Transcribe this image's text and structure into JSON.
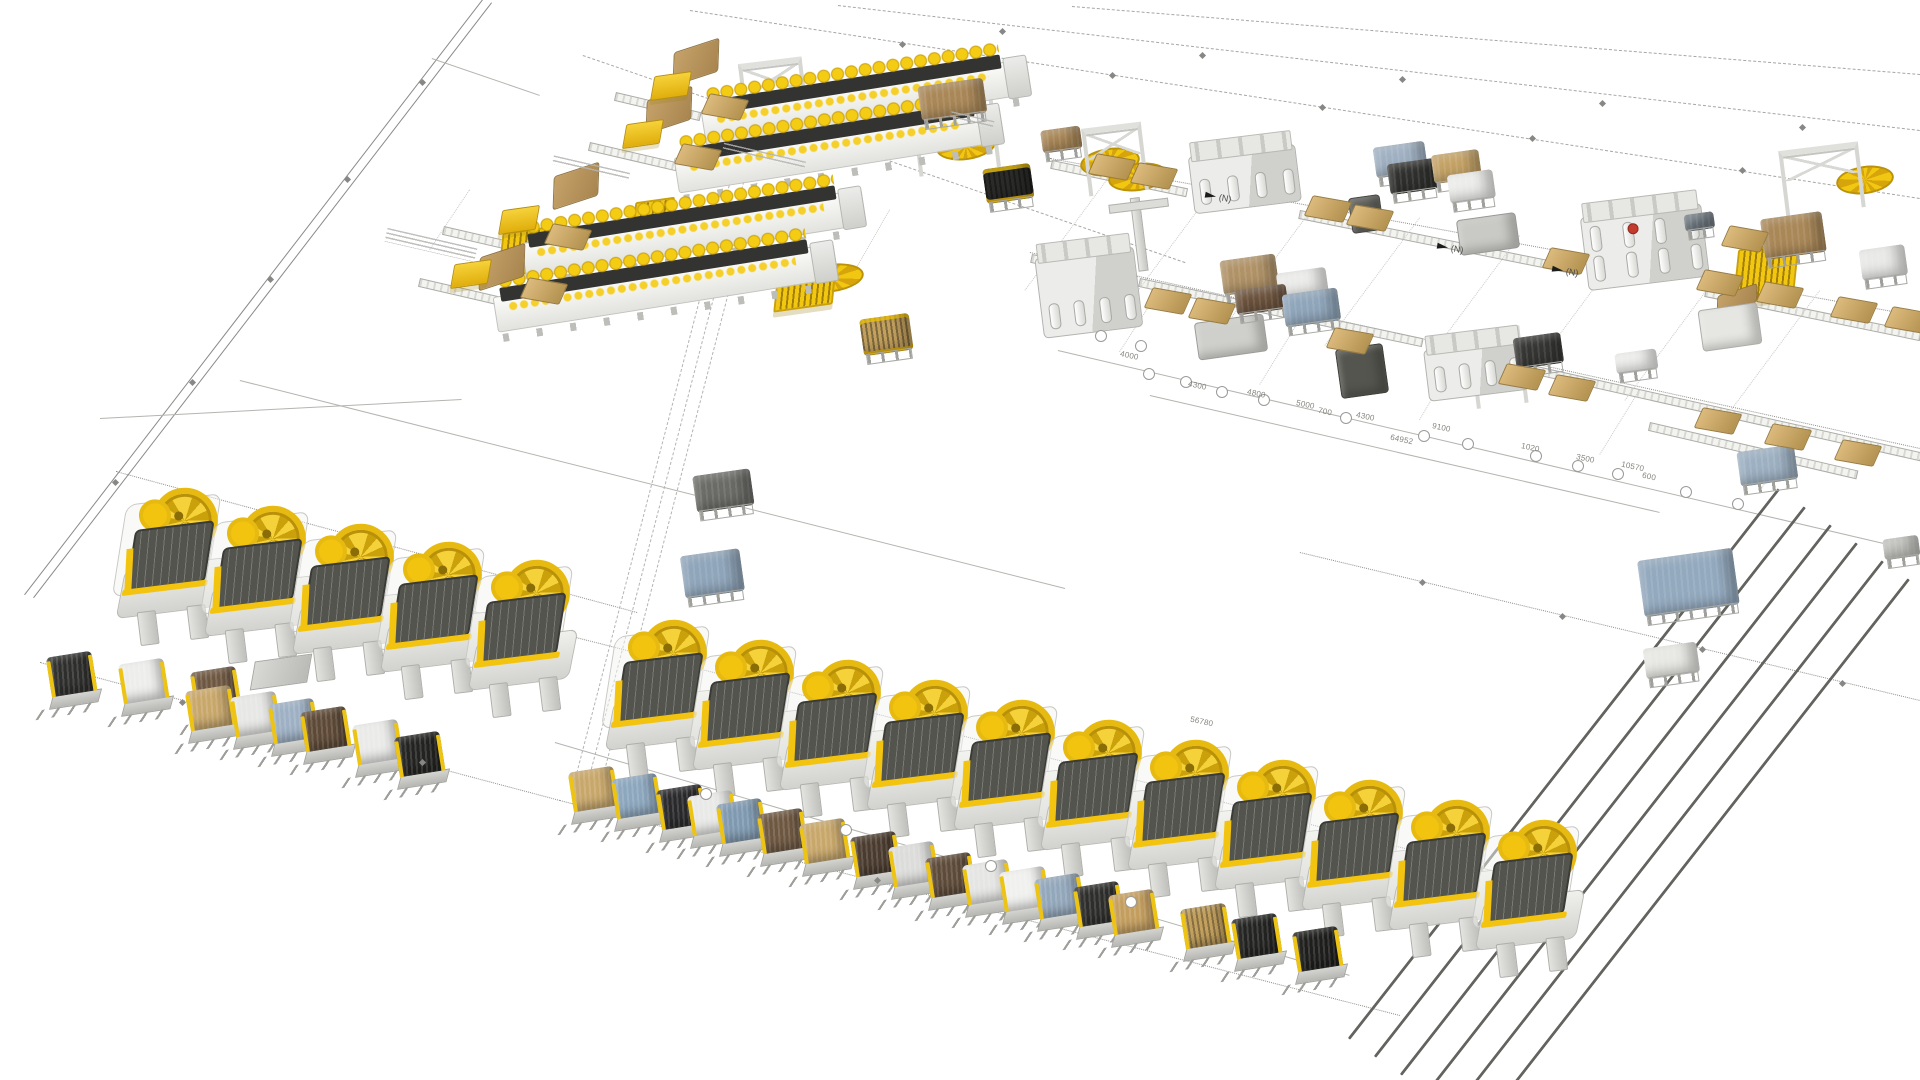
{
  "document": {
    "kind": "isometric 3D plant layout drawing",
    "background_color": "#ffffff"
  },
  "palette": {
    "accent_yellow": "#f2c40f",
    "machine_light": "#e9e9e5",
    "machine_dark": "#54544e",
    "bale_tan": "#c8a76a",
    "line_gray": "#9c9c9a",
    "logo_red": "#c23b2e"
  },
  "flow_markers": [
    {
      "label": "(N)",
      "x": 1205,
      "y": 192
    },
    {
      "label": "(N)",
      "x": 1437,
      "y": 243
    },
    {
      "label": "(N)",
      "x": 1552,
      "y": 266
    }
  ],
  "dimension_labels": [
    {
      "text": "4000",
      "x": 1120,
      "y": 352
    },
    {
      "text": "4300",
      "x": 1188,
      "y": 382
    },
    {
      "text": "4800",
      "x": 1247,
      "y": 390
    },
    {
      "text": "5000",
      "x": 1296,
      "y": 401
    },
    {
      "text": "700",
      "x": 1318,
      "y": 408
    },
    {
      "text": "4300",
      "x": 1356,
      "y": 413
    },
    {
      "text": "64952",
      "x": 1390,
      "y": 436
    },
    {
      "text": "9100",
      "x": 1432,
      "y": 424
    },
    {
      "text": "1020",
      "x": 1521,
      "y": 444
    },
    {
      "text": "3500",
      "x": 1576,
      "y": 455
    },
    {
      "text": "10570",
      "x": 1621,
      "y": 463
    },
    {
      "text": "600",
      "x": 1642,
      "y": 473
    },
    {
      "text": "56780",
      "x": 1190,
      "y": 718
    }
  ],
  "scene": {
    "lines": [
      [
        483,
        0,
        25,
        595,
        "solid"
      ],
      [
        492,
        3,
        34,
        598,
        "solid"
      ],
      [
        690,
        10,
        1920,
        198,
        "dashed"
      ],
      [
        838,
        5,
        1920,
        130,
        "dashed"
      ],
      [
        1072,
        6,
        1920,
        74,
        "dashed"
      ],
      [
        583,
        55,
        1185,
        262,
        "dashed"
      ],
      [
        432,
        58,
        540,
        95,
        "dim"
      ],
      [
        100,
        418,
        462,
        399,
        "dim"
      ],
      [
        116,
        471,
        637,
        612,
        "dotted"
      ],
      [
        240,
        380,
        1065,
        588,
        "dim"
      ],
      [
        1050,
        158,
        1920,
        316,
        "dotted"
      ],
      [
        1030,
        252,
        1920,
        448,
        "dotted"
      ],
      [
        1058,
        350,
        1905,
        548,
        "dim"
      ],
      [
        1150,
        395,
        1660,
        512,
        "dim"
      ],
      [
        1300,
        552,
        1920,
        700,
        "dotted"
      ],
      [
        40,
        662,
        560,
        800,
        "dotted"
      ],
      [
        560,
        800,
        1400,
        1015,
        "dotted"
      ],
      [
        470,
        610,
        1570,
        890,
        "dotted"
      ],
      [
        555,
        742,
        1350,
        975,
        "dim"
      ],
      [
        753,
        148,
        588,
        784,
        "spine"
      ],
      [
        765,
        154,
        600,
        790,
        "spine"
      ],
      [
        741,
        142,
        576,
        778,
        "spine"
      ],
      [
        1780,
        490,
        1350,
        1040,
        "rail"
      ],
      [
        1806,
        508,
        1376,
        1058,
        "rail"
      ],
      [
        1832,
        526,
        1402,
        1076,
        "rail"
      ],
      [
        1858,
        544,
        1428,
        1094,
        "rail"
      ],
      [
        1884,
        562,
        1454,
        1112,
        "rail"
      ],
      [
        1910,
        580,
        1480,
        1130,
        "rail"
      ],
      [
        1052,
        160,
        1186,
        188,
        "conv"
      ],
      [
        1300,
        210,
        1578,
        266,
        "conv"
      ],
      [
        1706,
        288,
        1920,
        332,
        "conv"
      ],
      [
        1032,
        254,
        1136,
        276,
        "conv"
      ],
      [
        1140,
        278,
        1422,
        338,
        "conv"
      ],
      [
        1528,
        364,
        1920,
        452,
        "conv"
      ],
      [
        1650,
        422,
        1856,
        470,
        "conv"
      ],
      [
        616,
        92,
        700,
        112,
        "conv"
      ],
      [
        590,
        142,
        676,
        162,
        "conv"
      ],
      [
        444,
        226,
        522,
        244,
        "conv"
      ],
      [
        420,
        278,
        498,
        296,
        "conv"
      ],
      [
        1120,
        163,
        1025,
        291,
        "faint"
      ],
      [
        1220,
        181,
        1125,
        309,
        "faint"
      ],
      [
        1320,
        199,
        1225,
        327,
        "faint"
      ],
      [
        1420,
        218,
        1325,
        346,
        "faint"
      ],
      [
        1520,
        236,
        1425,
        364,
        "faint"
      ],
      [
        1620,
        254,
        1525,
        382,
        "faint"
      ],
      [
        1720,
        273,
        1625,
        401,
        "faint"
      ],
      [
        1820,
        291,
        1725,
        419,
        "faint"
      ],
      [
        1160,
        290,
        1120,
        352,
        "faint"
      ],
      [
        1300,
        320,
        1260,
        385,
        "faint"
      ],
      [
        1460,
        352,
        1420,
        420,
        "faint"
      ],
      [
        1640,
        390,
        1600,
        455,
        "faint"
      ],
      [
        1800,
        425,
        1760,
        492,
        "faint"
      ],
      [
        470,
        190,
        430,
        250,
        "faint"
      ],
      [
        890,
        210,
        850,
        280,
        "faint"
      ]
    ],
    "fiber_opening_machines": [
      [
        118,
        498
      ],
      [
        206,
        516
      ],
      [
        294,
        534
      ],
      [
        382,
        552
      ],
      [
        470,
        570
      ],
      [
        607,
        630
      ],
      [
        694,
        650
      ],
      [
        781,
        670
      ],
      [
        868,
        690
      ],
      [
        955,
        710
      ],
      [
        1042,
        730
      ],
      [
        1129,
        750
      ],
      [
        1216,
        770
      ],
      [
        1303,
        790
      ],
      [
        1390,
        810
      ],
      [
        1477,
        830
      ]
    ],
    "bobbin_machines": [
      [
        700,
        64,
        330
      ],
      [
        673,
        112,
        330
      ],
      [
        520,
        196,
        345
      ],
      [
        492,
        250,
        345
      ]
    ],
    "lids": [
      [
        672,
        46,
        46,
        30
      ],
      [
        645,
        94,
        46,
        30
      ],
      [
        552,
        170,
        46,
        30
      ],
      [
        478,
        251,
        46,
        30
      ],
      [
        1716,
        290,
        40,
        16
      ]
    ],
    "yellow_feeders": [
      [
        652,
        74
      ],
      [
        624,
        122
      ],
      [
        500,
        208
      ],
      [
        452,
        262
      ]
    ],
    "presses": [
      {
        "x": 1190,
        "y": 136,
        "w": 108,
        "h": 72,
        "variant": "roof"
      },
      {
        "x": 1038,
        "y": 238,
        "w": 100,
        "h": 95,
        "variant": "mast"
      },
      {
        "x": 1425,
        "y": 330,
        "w": 100,
        "h": 66,
        "variant": "roof"
      },
      {
        "x": 1583,
        "y": 196,
        "w": 122,
        "h": 88,
        "variant": "big"
      }
    ],
    "machine_boxes": [
      [
        1458,
        216,
        58,
        34,
        "#c9c9c5"
      ],
      [
        1350,
        196,
        30,
        34,
        "#5f5f5b"
      ],
      [
        1338,
        346,
        46,
        48,
        "#55554f"
      ],
      [
        1196,
        318,
        68,
        36,
        "#cfcfcb"
      ],
      [
        1700,
        306,
        58,
        40,
        "#e6e6e2"
      ]
    ],
    "gantries": [
      [
        742,
        60,
        56,
        66
      ],
      [
        914,
        86,
        74,
        80
      ],
      [
        1085,
        125,
        52,
        62
      ],
      [
        1472,
        328,
        44,
        72
      ],
      [
        1782,
        146,
        72,
        60
      ]
    ],
    "turntables": [
      [
        936,
        132,
        56,
        24
      ],
      [
        1080,
        148,
        56,
        24
      ],
      [
        1108,
        163,
        56,
        24
      ],
      [
        1836,
        166,
        54,
        24
      ],
      [
        800,
        264,
        60,
        24
      ]
    ],
    "racks": [
      [
        500,
        230,
        46,
        40
      ],
      [
        633,
        200,
        36,
        36
      ],
      [
        775,
        270,
        56,
        34
      ],
      [
        1735,
        246,
        58,
        50
      ]
    ],
    "pallet_stacks": [
      [
        920,
        82,
        66,
        44,
        "#a98757",
        0
      ],
      [
        1042,
        128,
        40,
        32,
        "#a98757",
        0
      ],
      [
        1375,
        144,
        52,
        40,
        "#9fb0c2",
        0
      ],
      [
        1389,
        161,
        48,
        40,
        "#2f2f2d",
        0
      ],
      [
        1433,
        152,
        48,
        38,
        "#c4a265",
        0
      ],
      [
        1449,
        172,
        46,
        38,
        "#ececea",
        0
      ],
      [
        1222,
        257,
        56,
        44,
        "#b09267",
        0
      ],
      [
        1278,
        270,
        50,
        36,
        "#ececea",
        0
      ],
      [
        1236,
        287,
        52,
        34,
        "#6b523c",
        0
      ],
      [
        1284,
        291,
        56,
        42,
        "#8fa5ba",
        0
      ],
      [
        1515,
        335,
        48,
        40,
        "#353533",
        0
      ],
      [
        1616,
        351,
        42,
        30,
        "#f0f0ee",
        0
      ],
      [
        1685,
        213,
        30,
        26,
        "#6f7a82",
        0
      ],
      [
        1763,
        215,
        62,
        50,
        "#a98757",
        0
      ],
      [
        1861,
        247,
        46,
        40,
        "#e9e9e7",
        0
      ],
      [
        695,
        472,
        58,
        46,
        "#6a6a66",
        0
      ],
      [
        683,
        552,
        60,
        52,
        "#8fa5ba",
        0
      ],
      [
        1641,
        554,
        96,
        66,
        "#93a9be",
        0
      ],
      [
        1645,
        645,
        54,
        40,
        "#e8e8e4",
        0
      ],
      [
        1739,
        448,
        58,
        44,
        "#9db0c2",
        0
      ],
      [
        1884,
        537,
        36,
        30,
        "#c2c2be",
        0
      ],
      [
        862,
        316,
        50,
        46,
        "#c2a05e",
        1
      ],
      [
        985,
        166,
        48,
        44,
        "#2b2b29",
        1
      ]
    ],
    "stand_bales": [
      [
        46,
        654,
        "#2e2e2c",
        0
      ],
      [
        118,
        661,
        "#ededeb",
        0
      ],
      [
        190,
        669,
        "#6e5741",
        0
      ],
      [
        185,
        688,
        "#c8a76a",
        0
      ],
      [
        230,
        694,
        "#e7e7e5",
        0
      ],
      [
        268,
        701,
        "#9db0c4",
        0
      ],
      [
        300,
        709,
        "#5d4936",
        0
      ],
      [
        352,
        722,
        "#eaeae8",
        0
      ],
      [
        394,
        734,
        "#232321",
        0
      ],
      [
        568,
        769,
        "#c8a76a",
        0
      ],
      [
        611,
        776,
        "#8ca6bd",
        0
      ],
      [
        656,
        787,
        "#29292b",
        0
      ],
      [
        687,
        793,
        "#e9e9e7",
        0
      ],
      [
        716,
        801,
        "#7f99b0",
        0
      ],
      [
        757,
        811,
        "#6e5741",
        0
      ],
      [
        799,
        821,
        "#c8a76a",
        0
      ],
      [
        850,
        834,
        "#4a3b2e",
        0
      ],
      [
        888,
        844,
        "#dcdcda",
        0
      ],
      [
        925,
        855,
        "#5d4a38",
        0
      ],
      [
        962,
        862,
        "#e5e5e3",
        0
      ],
      [
        999,
        869,
        "#f0f0ee",
        0
      ],
      [
        1034,
        876,
        "#93a7bb",
        0
      ],
      [
        1073,
        884,
        "#2d2d2b",
        0
      ],
      [
        1108,
        892,
        "#c49e5e",
        0
      ],
      [
        1180,
        906,
        "#c2a05e",
        1
      ],
      [
        1231,
        916,
        "#232321",
        0
      ],
      [
        1292,
        929,
        "#1e1e1c",
        0
      ]
    ],
    "gray_trays": [
      [
        252,
        658
      ]
    ],
    "conveyor_bales": [
      [
        1092,
        156
      ],
      [
        1134,
        165
      ],
      [
        1308,
        198
      ],
      [
        1350,
        207
      ],
      [
        1546,
        250
      ],
      [
        1700,
        272
      ],
      [
        1760,
        284
      ],
      [
        1834,
        299
      ],
      [
        1888,
        309
      ],
      [
        1148,
        290
      ],
      [
        1192,
        300
      ],
      [
        1330,
        330
      ],
      [
        1502,
        366
      ],
      [
        1552,
        377
      ],
      [
        1698,
        410
      ],
      [
        1768,
        426
      ],
      [
        1838,
        442
      ],
      [
        705,
        96
      ],
      [
        678,
        146
      ],
      [
        548,
        226
      ],
      [
        524,
        280
      ],
      [
        1725,
        228
      ]
    ],
    "balloons": [
      [
        1143,
        368
      ],
      [
        1180,
        376
      ],
      [
        1216,
        386
      ],
      [
        1258,
        394
      ],
      [
        1340,
        412
      ],
      [
        1418,
        430
      ],
      [
        1462,
        438
      ],
      [
        1530,
        450
      ],
      [
        1572,
        460
      ],
      [
        1612,
        468
      ],
      [
        1680,
        486
      ],
      [
        1732,
        498
      ],
      [
        700,
        788
      ],
      [
        840,
        824
      ],
      [
        985,
        860
      ],
      [
        1125,
        896
      ],
      [
        1095,
        330
      ],
      [
        1135,
        340
      ]
    ],
    "diamonds": [
      [
        420,
        80
      ],
      [
        345,
        177
      ],
      [
        268,
        277
      ],
      [
        190,
        380
      ],
      [
        113,
        480
      ],
      [
        900,
        42
      ],
      [
        1110,
        73
      ],
      [
        1320,
        105
      ],
      [
        1530,
        136
      ],
      [
        1740,
        168
      ],
      [
        1000,
        29
      ],
      [
        1200,
        53
      ],
      [
        1400,
        77
      ],
      [
        1600,
        101
      ],
      [
        1800,
        125
      ],
      [
        1420,
        580
      ],
      [
        1560,
        614
      ],
      [
        1700,
        647
      ],
      [
        1840,
        681
      ],
      [
        180,
        700
      ],
      [
        420,
        760
      ],
      [
        875,
        878
      ]
    ],
    "notes": [
      [
        385,
        238,
        92,
        3
      ],
      [
        552,
        164,
        78,
        2
      ],
      [
        722,
        152,
        84,
        2
      ],
      [
        950,
        116,
        44,
        2
      ]
    ]
  }
}
